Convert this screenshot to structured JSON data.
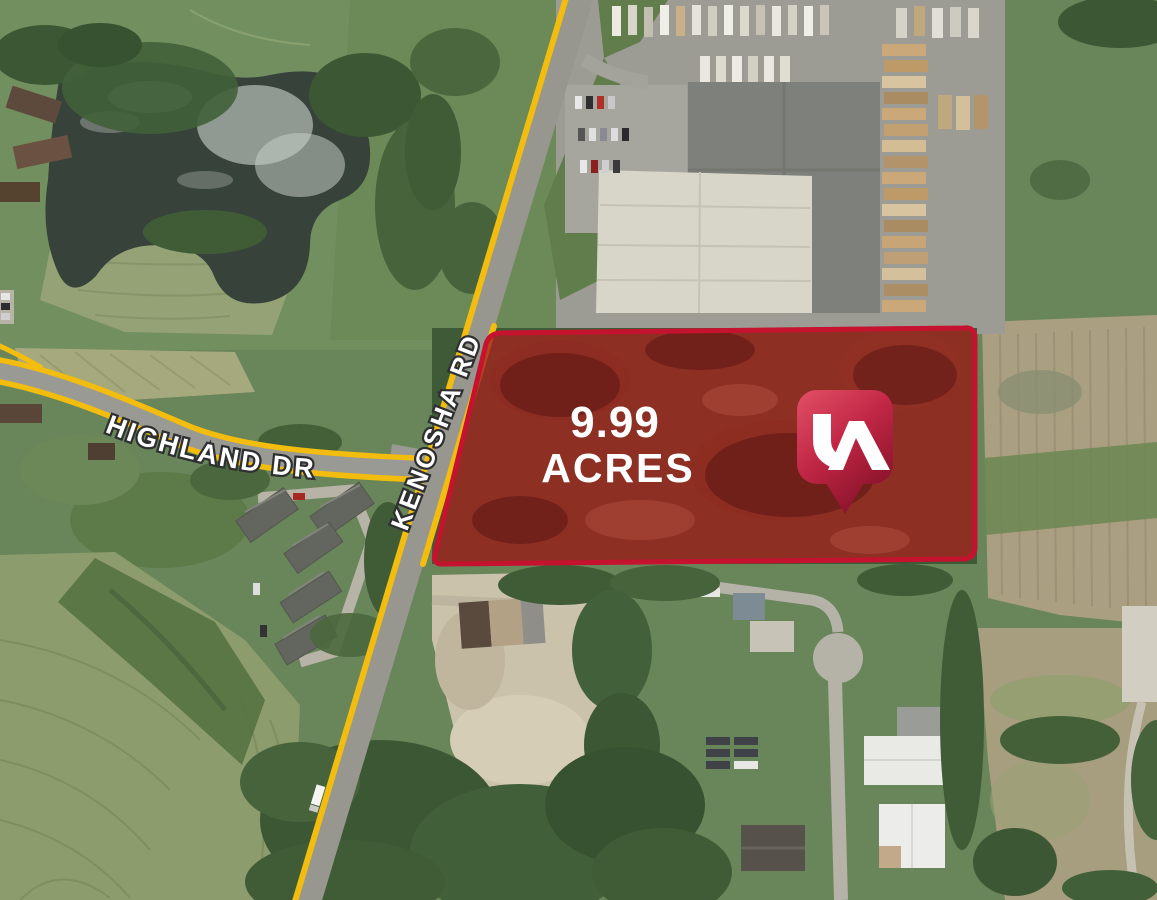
{
  "title": "Aerial land listing map",
  "map": {
    "acreage": {
      "line1": "9.99",
      "line2": "ACRES",
      "text_color": "#ffffff"
    },
    "roads": {
      "highland_label": "HIGHLAND DR",
      "kenosha_label": "KENOSHA RD",
      "highlight_color": "#f2bd0e",
      "label_color": "#ffffff",
      "label_outline": "#2e2f31"
    },
    "parcel": {
      "fill_color": "#a5231f",
      "border_color": "#c5122f"
    },
    "logo": {
      "monogram": "LA",
      "monogram_color": "#ffffff",
      "gradient_top": "#e25066",
      "gradient_mid": "#c12745",
      "gradient_bottom": "#7a0d24"
    }
  }
}
